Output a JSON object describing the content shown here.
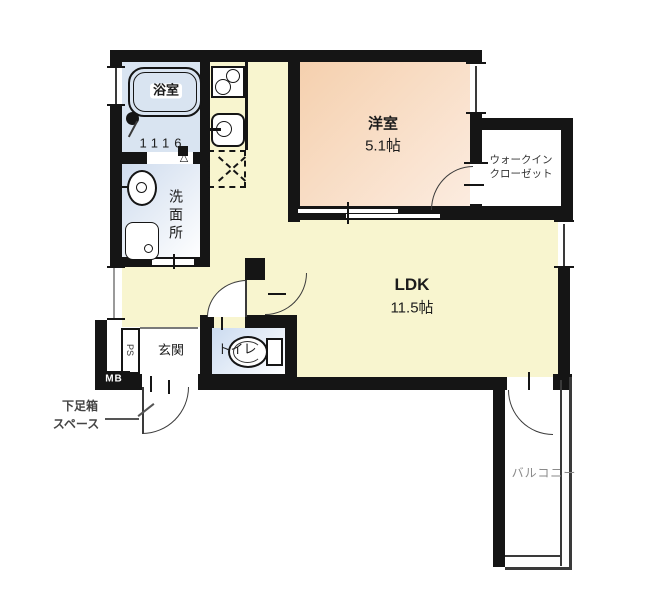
{
  "rooms": {
    "bathroom": {
      "label": "浴室",
      "unit_size": "1116"
    },
    "washroom": {
      "label": "洗面所"
    },
    "western_room": {
      "label": "洋室",
      "area": "5.1帖"
    },
    "walk_in_closet": {
      "label_line1": "ウォークイン",
      "label_line2": "クローゼット"
    },
    "ldk": {
      "label": "LDK",
      "area": "11.5帖"
    },
    "entrance": {
      "label": "玄関"
    },
    "toilet": {
      "label": "トイレ"
    },
    "balcony": {
      "label": "バルコニー"
    },
    "pipe_space": {
      "label": "PS"
    },
    "meter_box": {
      "label": "MB"
    }
  },
  "annotations": {
    "shoe_box_line1": "下足箱",
    "shoe_box_line2": "スペース"
  },
  "colors": {
    "wall": "#151515",
    "ldk_fill": "#f8f5cf",
    "western_room_fill": "#f6d4b8",
    "bathroom_fill": "#d9e4f1",
    "washroom_fill": "#dde8f4",
    "toilet_fill": "#d3e0f2",
    "balcony_fill": "#eed2ea",
    "closet_fill": "#ffffff",
    "muted_text": "#8a8a8a"
  }
}
